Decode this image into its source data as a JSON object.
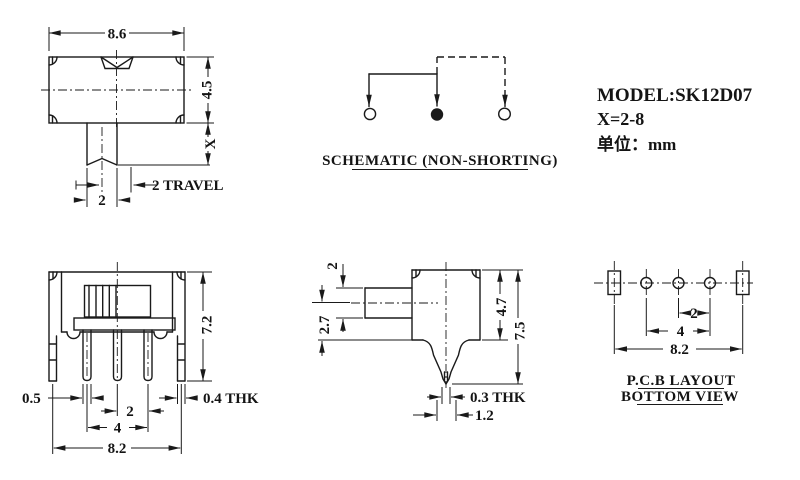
{
  "drawing": {
    "background": "#ffffff",
    "line_color": "#1a1a1a",
    "info": {
      "model": "MODEL:SK12D07",
      "x_range": "X=2-8",
      "unit": "单位：mm"
    },
    "front_view": {
      "dim_width": "8.6",
      "dim_height": "4.5",
      "dim_stem_length": "X",
      "dim_travel": "2 TRAVEL",
      "dim_stem_width": "2"
    },
    "schematic": {
      "label": "SCHEMATIC (NON-SHORTING)"
    },
    "pin_view": {
      "dim_height": "7.2",
      "dim_pin_width": "0.5",
      "dim_pin_pitch": "2",
      "dim_pin_span": "4",
      "dim_bracket_span": "8.2",
      "dim_bracket_thk": "0.4 THK"
    },
    "side_view": {
      "dim_knob_width": "2",
      "dim_center_offset": "2.7",
      "dim_body_height": "4.7",
      "dim_total_height": "7.5",
      "dim_pin_thk": "0.3 THK",
      "dim_pin_base": "1.2"
    },
    "pcb_layout": {
      "dim_pitch": "2",
      "dim_span": "4",
      "dim_bracket_span": "8.2",
      "label_line1": "P.C.B LAYOUT",
      "label_line2": "BOTTOM VIEW"
    }
  }
}
